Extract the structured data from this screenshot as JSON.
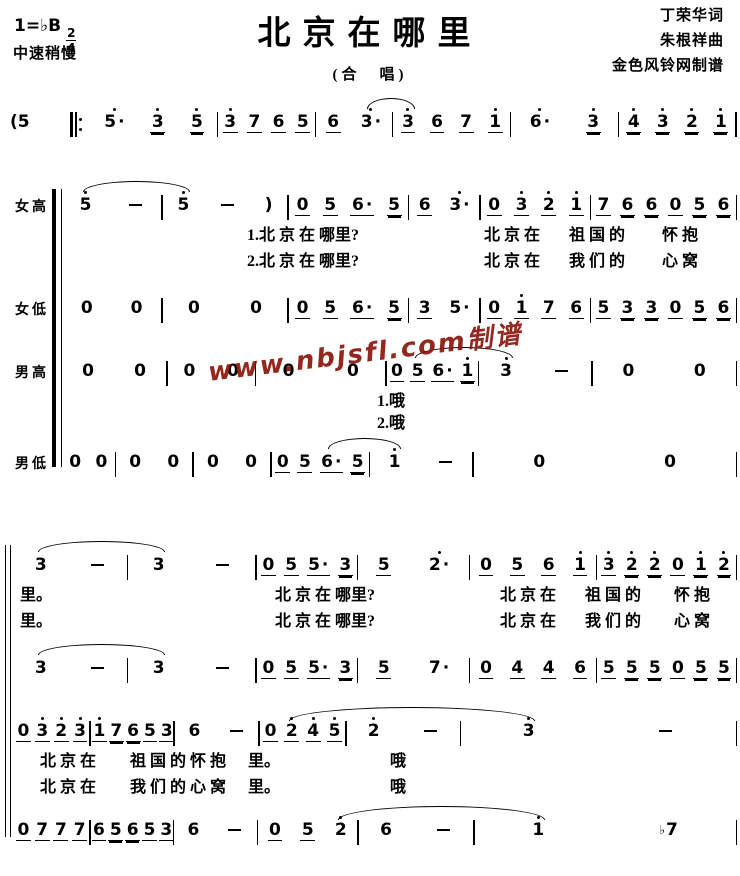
{
  "header": {
    "key": "1=♭B",
    "time_numerator": "2",
    "time_denominator": "4",
    "tempo": "中速稍慢",
    "title": "北京在哪里",
    "subtitle": "(合　唱)",
    "credits": [
      "丁荣华词",
      "朱根祥曲",
      "金色风铃网制谱"
    ]
  },
  "watermark": {
    "text": "www.nbjsfl.com制谱",
    "color": "#8b150c"
  },
  "score": {
    "intro": {
      "prefix": "(5",
      "repeat": true,
      "measures": [
        {
          "w": 130,
          "notes": [
            "5'.",
            "3'=",
            "5'="
          ]
        },
        {
          "w": 100,
          "notes": [
            "3'_",
            "7_",
            "6_",
            "5_"
          ]
        },
        {
          "w": 78,
          "notes": [
            "6_",
            "3'."
          ]
        },
        {
          "w": 120,
          "notes": [
            "3'_",
            "6_",
            "7_",
            "1'_"
          ]
        },
        {
          "w": 110,
          "notes": [
            "6'.",
            "3'="
          ]
        },
        {
          "w": 120,
          "notes": [
            "4'=",
            "3'=",
            "2'=",
            "1'="
          ]
        }
      ],
      "arcs": [
        {
          "from": [
            2,
            1
          ],
          "to": [
            3,
            0
          ]
        }
      ]
    },
    "system1": [
      {
        "label": "女高",
        "measures": [
          {
            "w": 100,
            "notes": [
              "5'",
              "-"
            ]
          },
          {
            "w": 125,
            "notes": [
              "5'",
              "-",
              ")"
            ]
          },
          {
            "w": 120,
            "notes": [
              "0_",
              "5_",
              "6_.",
              "5="
            ]
          },
          {
            "w": 70,
            "notes": [
              "6_",
              "3'."
            ]
          },
          {
            "w": 110,
            "notes": [
              "0_",
              "3'_",
              "2'_",
              "1'_"
            ]
          },
          {
            "w": 145,
            "notes": [
              "7_",
              "6=",
              "6=",
              "0_",
              "5=",
              "6="
            ]
          }
        ],
        "arcs": [
          {
            "from": [
              0,
              0
            ],
            "to": [
              1,
              0
            ]
          }
        ],
        "lyrics": [
          {
            "segments": [
              {
                "t": "1.北 京 在 哪里?",
                "x": 185
              },
              {
                "t": "北 京 在",
                "x": 422
              },
              {
                "t": "祖 国 的",
                "x": 507
              },
              {
                "t": "怀  抱",
                "x": 600
              }
            ]
          },
          {
            "segments": [
              {
                "t": "2.北 京 在 哪里?",
                "x": 185
              },
              {
                "t": "北 京 在",
                "x": 422
              },
              {
                "t": "我 们 的",
                "x": 507
              },
              {
                "t": "心  窝",
                "x": 600
              }
            ]
          }
        ]
      },
      {
        "label": "女低",
        "measures": [
          {
            "w": 100,
            "notes": [
              "0",
              "0"
            ]
          },
          {
            "w": 125,
            "notes": [
              "0",
              "0"
            ]
          },
          {
            "w": 120,
            "notes": [
              "0_",
              "5_",
              "6_.",
              "5="
            ]
          },
          {
            "w": 70,
            "notes": [
              "3_",
              "5."
            ]
          },
          {
            "w": 110,
            "notes": [
              "0_",
              "1'_",
              "7_",
              "6_"
            ]
          },
          {
            "w": 145,
            "notes": [
              "5_",
              "3=",
              "3=",
              "0_",
              "5=",
              "6="
            ]
          }
        ],
        "arcs": [],
        "lyrics": []
      },
      {
        "label": "男高",
        "measures": [
          {
            "w": 105,
            "notes": [
              "0",
              "0"
            ]
          },
          {
            "w": 88,
            "notes": [
              "0",
              "0"
            ]
          },
          {
            "w": 130,
            "notes": [
              "0",
              "0"
            ]
          },
          {
            "w": 92,
            "notes": [
              "0_",
              "5_",
              "6_.",
              "1'="
            ]
          },
          {
            "w": 113,
            "notes": [
              "3'",
              "-"
            ]
          },
          {
            "w": 144,
            "notes": [
              "0",
              "0"
            ]
          }
        ],
        "arcs": [
          {
            "from": [
              3,
              1
            ],
            "to": [
              4,
              0
            ]
          }
        ],
        "lyrics": [
          {
            "segments": [
              {
                "t": "1.哦",
                "x": 315
              }
            ]
          },
          {
            "segments": [
              {
                "t": "2.哦",
                "x": 315
              }
            ]
          }
        ]
      },
      {
        "label": "男低",
        "measures": [
          {
            "w": 53,
            "notes": [
              "0",
              "0"
            ]
          },
          {
            "w": 77,
            "notes": [
              "0",
              "0"
            ]
          },
          {
            "w": 77,
            "notes": [
              "0",
              "0"
            ]
          },
          {
            "w": 98,
            "notes": [
              "0_",
              "5_",
              "6_.",
              "5="
            ]
          },
          {
            "w": 103,
            "notes": [
              "1'",
              "-"
            ]
          },
          {
            "w": 264,
            "notes": [
              "0",
              "0"
            ]
          }
        ],
        "arcs": [
          {
            "from": [
              3,
              2
            ],
            "to": [
              4,
              0
            ]
          }
        ],
        "lyrics": []
      }
    ],
    "system2": [
      {
        "measures": [
          {
            "w": 114,
            "notes": [
              "3",
              "-"
            ]
          },
          {
            "w": 129,
            "notes": [
              "3",
              "-"
            ]
          },
          {
            "w": 101,
            "notes": [
              "0_",
              "5_",
              "5_.",
              "3="
            ]
          },
          {
            "w": 112,
            "notes": [
              "5_",
              "2'."
            ]
          },
          {
            "w": 127,
            "notes": [
              "0_",
              "5_",
              "6_",
              "1'_"
            ]
          },
          {
            "w": 140,
            "notes": [
              "3'_",
              "2'=",
              "2'=",
              "0_",
              "1'=",
              "2'="
            ]
          }
        ],
        "arcs": [
          {
            "from": [
              0,
              0
            ],
            "to": [
              1,
              0
            ]
          }
        ],
        "lyrics": [
          {
            "segments": [
              {
                "t": "里。",
                "x": 6
              },
              {
                "t": "北 京 在 哪里?",
                "x": 261
              },
              {
                "t": "北 京 在",
                "x": 486
              },
              {
                "t": "祖 国 的",
                "x": 571
              },
              {
                "t": "怀  抱",
                "x": 660
              }
            ]
          },
          {
            "segments": [
              {
                "t": "里。",
                "x": 6
              },
              {
                "t": "北 京 在 哪里?",
                "x": 261
              },
              {
                "t": "北 京 在",
                "x": 486
              },
              {
                "t": "我 们 的",
                "x": 571
              },
              {
                "t": "心  窝",
                "x": 660
              }
            ]
          }
        ]
      },
      {
        "measures": [
          {
            "w": 114,
            "notes": [
              "3",
              "-"
            ]
          },
          {
            "w": 129,
            "notes": [
              "3",
              "-"
            ]
          },
          {
            "w": 101,
            "notes": [
              "0_",
              "5_",
              "5_.",
              "3="
            ]
          },
          {
            "w": 112,
            "notes": [
              "5_",
              "7."
            ]
          },
          {
            "w": 127,
            "notes": [
              "0_",
              "4_",
              "4_",
              "6_"
            ]
          },
          {
            "w": 140,
            "notes": [
              "5_",
              "5=",
              "5=",
              "0_",
              "5=",
              "5="
            ]
          }
        ],
        "arcs": [
          {
            "from": [
              0,
              0
            ],
            "to": [
              1,
              0
            ]
          }
        ],
        "lyrics": []
      },
      {
        "measures": [
          {
            "w": 76,
            "notes": [
              "0_",
              "3'_",
              "2'_",
              "3'_"
            ]
          },
          {
            "w": 83,
            "notes": [
              "1'_",
              "7=",
              "6=",
              "5_",
              "3_"
            ]
          },
          {
            "w": 84,
            "notes": [
              "6",
              "-"
            ]
          },
          {
            "w": 86,
            "notes": [
              "0_",
              "2'_",
              "4'_",
              "5'_"
            ]
          },
          {
            "w": 114,
            "notes": [
              "2'",
              "-"
            ]
          },
          {
            "w": 276,
            "notes": [
              "3'",
              "-"
            ]
          }
        ],
        "arcs": [
          {
            "from": [
              3,
              1
            ],
            "to": [
              5,
              0
            ]
          }
        ],
        "lyrics": [
          {
            "segments": [
              {
                "t": "北 京 在",
                "x": 26
              },
              {
                "t": "祖 国 的 怀 抱",
                "x": 116
              },
              {
                "t": "里。",
                "x": 234
              },
              {
                "t": "哦",
                "x": 376
              }
            ]
          },
          {
            "segments": [
              {
                "t": "北 京 在",
                "x": 26
              },
              {
                "t": "我 们 的 心 窝",
                "x": 116
              },
              {
                "t": "里。",
                "x": 234
              },
              {
                "t": "哦",
                "x": 376
              }
            ]
          }
        ]
      },
      {
        "measures": [
          {
            "w": 76,
            "notes": [
              "0_",
              "7_",
              "7_",
              "7_"
            ]
          },
          {
            "w": 83,
            "notes": [
              "6_",
              "5=",
              "6=",
              "5_",
              "3_"
            ]
          },
          {
            "w": 84,
            "notes": [
              "6",
              "-"
            ]
          },
          {
            "w": 100,
            "notes": [
              "0_",
              "5_",
              "2'"
            ]
          },
          {
            "w": 116,
            "notes": [
              "6",
              "-"
            ]
          },
          {
            "w": 264,
            "notes": [
              "1'",
              "b7"
            ]
          }
        ],
        "arcs": [
          {
            "from": [
              3,
              2
            ],
            "to": [
              5,
              0
            ]
          }
        ],
        "lyrics": []
      }
    ]
  }
}
